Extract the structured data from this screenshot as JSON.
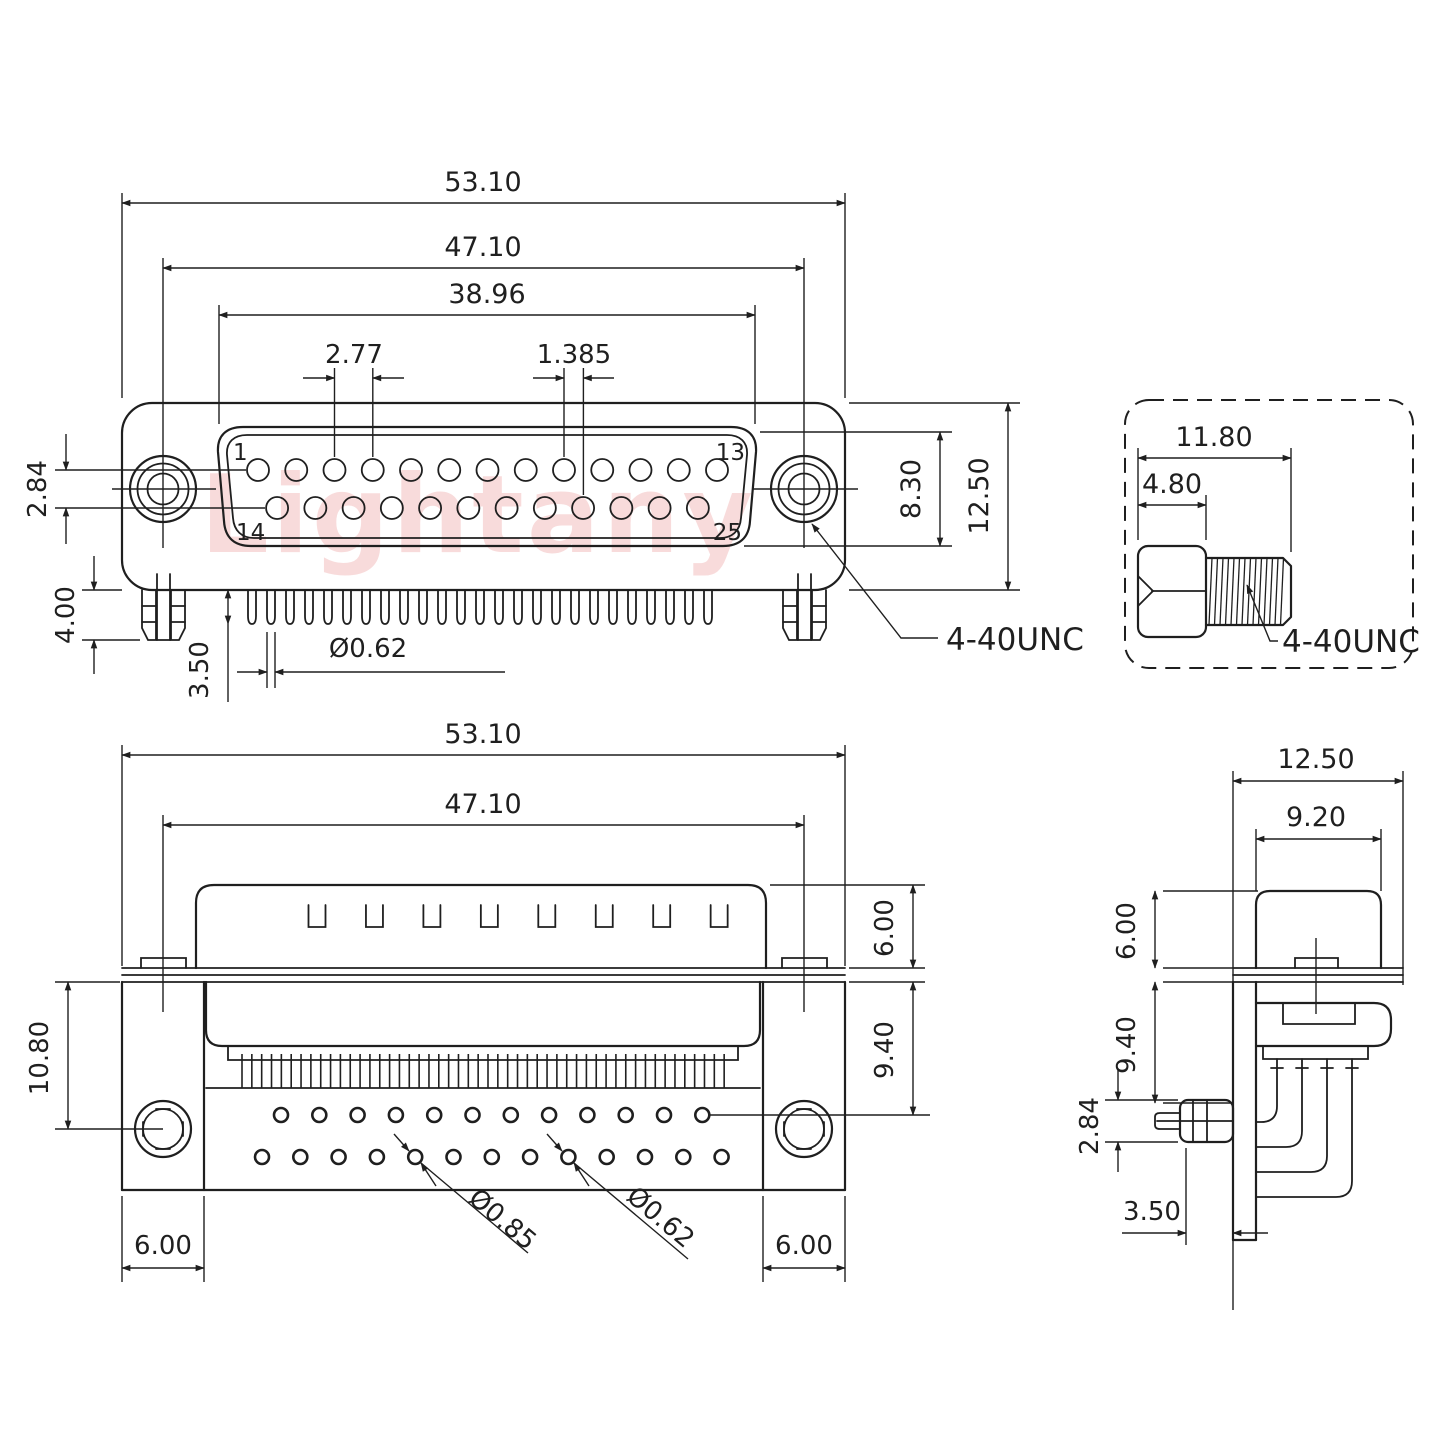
{
  "watermark": {
    "text": "Lightany",
    "color": "#f3b9b9"
  },
  "colors": {
    "line": "#1f1f1f",
    "background": "#ffffff"
  },
  "views": {
    "front": {
      "dims": {
        "total_width": "53.10",
        "mount_spacing": "47.10",
        "face_width": "38.96",
        "pin_pitch": "2.77",
        "half_pitch": "1.385",
        "row_gap": "2.84",
        "lock_length": "4.00",
        "pin_exit": "3.50",
        "pin_diameter": "Ø0.62",
        "face_height": "8.30",
        "shell_height": "12.50",
        "thread_callout": "4-40UNC"
      },
      "pins": {
        "first_top": "1",
        "last_top": "13",
        "first_bottom": "14",
        "last_bottom": "25"
      }
    },
    "screw_detail": {
      "dims": {
        "total_length": "11.80",
        "head_length": "4.80",
        "thread_callout": "4-40UNC"
      }
    },
    "rear": {
      "dims": {
        "total_width": "53.10",
        "mount_spacing": "47.10",
        "shell_height": "6.00",
        "rear_depth": "9.40",
        "hole_drop": "10.80",
        "left_bracket_width": "6.00",
        "right_bracket_width": "6.00",
        "large_hole_diameter": "Ø0.85",
        "small_hole_diameter": "Ø0.62"
      }
    },
    "side": {
      "dims": {
        "total_depth": "12.50",
        "shell_depth": "9.20",
        "shell_height": "6.00",
        "rear_depth": "9.40",
        "clip_height": "2.84",
        "pin_offset": "3.50"
      }
    }
  }
}
